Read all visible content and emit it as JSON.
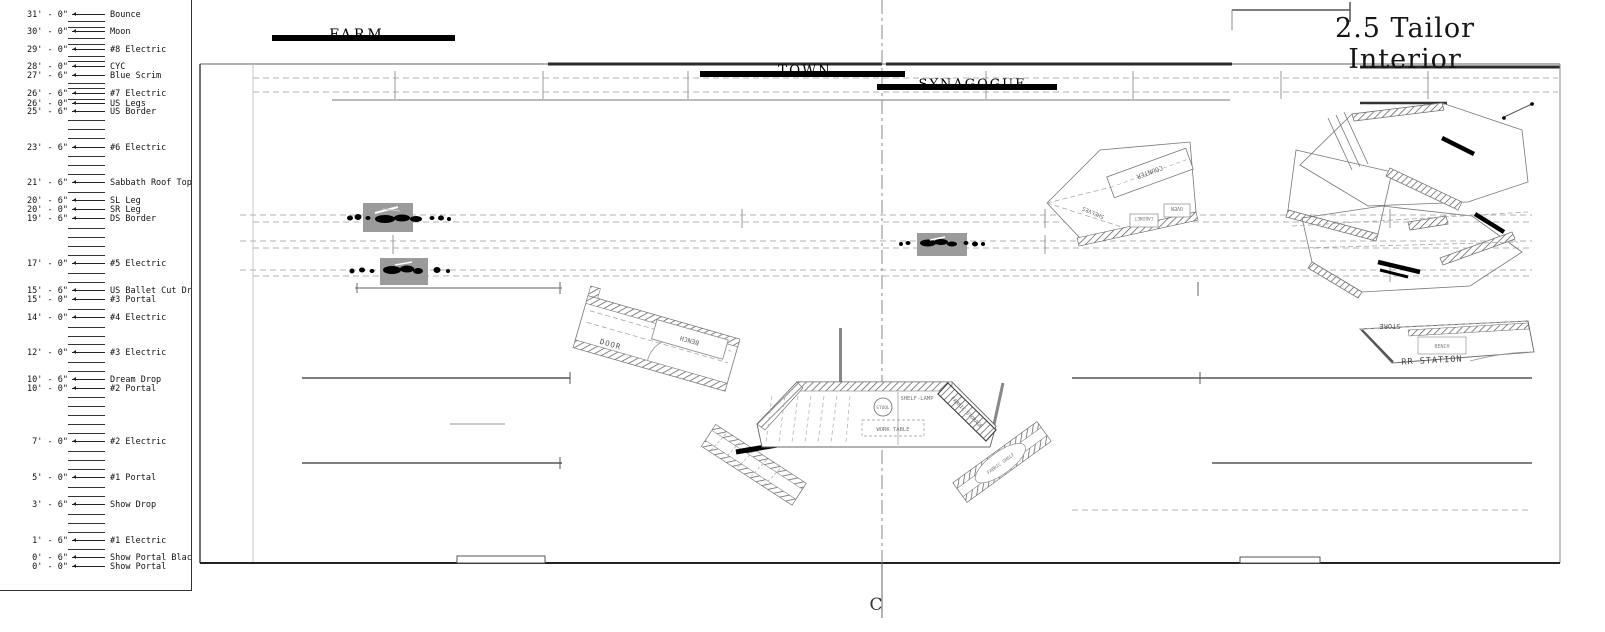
{
  "title": "2.5 Tailor Interior",
  "scene_bars": {
    "farm": "FARM",
    "town": "TOWN",
    "synagogue": "SYNAGOGUE"
  },
  "centerline": {
    "symbol": "C"
  },
  "lineset_schedule": {
    "rows": [
      {
        "y": 15,
        "height": "31' - 0\"",
        "label": "Bounce"
      },
      {
        "y": 32,
        "height": "30' - 0\"",
        "label": "Moon"
      },
      {
        "y": 50,
        "height": "29' - 0\"",
        "label": "#8 Electric"
      },
      {
        "y": 67,
        "height": "28' - 0\"",
        "label": "CYC"
      },
      {
        "y": 76,
        "height": "27' - 6\"",
        "label": "Blue Scrim"
      },
      {
        "y": 94,
        "height": "26' - 6\"",
        "label": "#7 Electric"
      },
      {
        "y": 104,
        "height": "26' - 0\"",
        "label": "US Legs"
      },
      {
        "y": 112,
        "height": "25' - 6\"",
        "label": "US Border"
      },
      {
        "y": 148,
        "height": "23' - 6\"",
        "label": "#6 Electric"
      },
      {
        "y": 183,
        "height": "21' - 6\"",
        "label": "Sabbath Roof Tops"
      },
      {
        "y": 201,
        "height": "20' - 6\"",
        "label": "SL Leg"
      },
      {
        "y": 210,
        "height": "20' - 0\"",
        "label": "SR Leg"
      },
      {
        "y": 219,
        "height": "19' - 6\"",
        "label": "DS Border"
      },
      {
        "y": 264,
        "height": "17' - 0\"",
        "label": "#5 Electric"
      },
      {
        "y": 291,
        "height": "15' - 6\"",
        "label": "US Ballet Cut Drop"
      },
      {
        "y": 300,
        "height": "15' - 0\"",
        "label": "#3 Portal"
      },
      {
        "y": 318,
        "height": "14' - 0\"",
        "label": "#4 Electric"
      },
      {
        "y": 353,
        "height": "12' - 0\"",
        "label": "#3 Electric"
      },
      {
        "y": 380,
        "height": "10' - 6\"",
        "label": "Dream Drop"
      },
      {
        "y": 389,
        "height": "10' - 0\"",
        "label": "#2 Portal"
      },
      {
        "y": 442,
        "height": "7' - 0\"",
        "label": "#2 Electric"
      },
      {
        "y": 478,
        "height": "5' - 0\"",
        "label": "#1 Portal"
      },
      {
        "y": 505,
        "height": "3' - 6\"",
        "label": "Show Drop"
      },
      {
        "y": 541,
        "height": "1' - 6\"",
        "label": "#1 Electric"
      },
      {
        "y": 558,
        "height": "0' - 6\"",
        "label": "Show Portal Blackout"
      },
      {
        "y": 567,
        "height": "0' - 0\"",
        "label": "Show Portal"
      }
    ],
    "ticks": [
      21,
      27,
      38,
      44,
      56,
      61,
      83,
      88,
      99,
      120,
      129,
      138,
      156,
      165,
      174,
      192,
      228,
      237,
      246,
      255,
      273,
      282,
      309,
      327,
      336,
      344,
      362,
      371,
      397,
      406,
      415,
      424,
      433,
      451,
      460,
      469,
      487,
      496,
      514,
      523,
      532,
      549
    ]
  },
  "piece_labels": {
    "bench_left": "BENCH",
    "door": "DOOR",
    "stool": "STOOL",
    "shelf_lamp": "SHELF-LAMP",
    "work_table": "WORK TABLE",
    "fabric_storage": "FABRIC STORAGE",
    "fabric_shelf": "FABRIC SHELF",
    "counter": "COUNTER",
    "shelves": "SHELVES",
    "cabinet": "CABINET",
    "oven": "OVEN",
    "store": "STORE",
    "bench_right": "BENCH",
    "rr_station": "RR STATION"
  }
}
